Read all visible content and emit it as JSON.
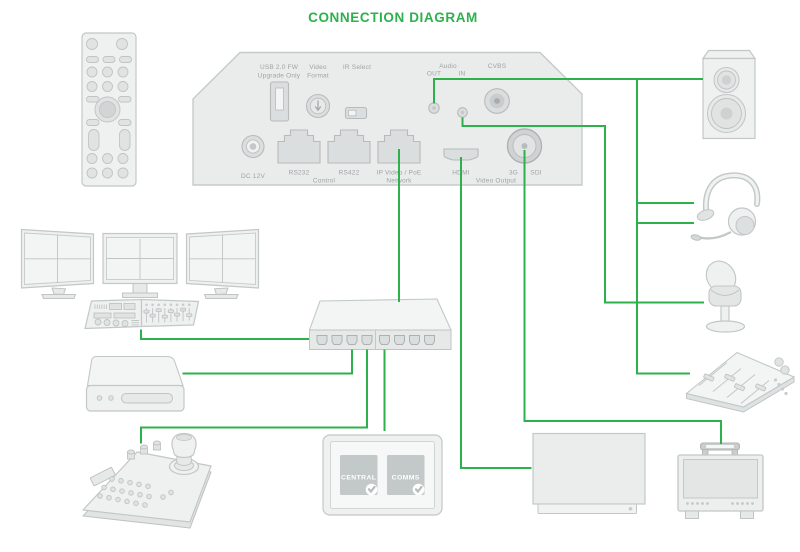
{
  "title": "CONNECTION DIAGRAM",
  "theme": {
    "accent": "#2CB14D",
    "device_stroke": "#C3C7C7",
    "device_fill": "#EFF0F0",
    "label_color": "#9EA4A4"
  },
  "rear_panel": {
    "labels": {
      "usb_line1": "USB 2.0 FW",
      "usb_line2": "Upgrade Only",
      "video_format_line1": "Video",
      "video_format_line2": "Format",
      "ir_select": "IR Select",
      "dc_12v": "DC 12V",
      "rs232": "RS232",
      "rs422": "RS422",
      "control": "Control",
      "ip_line1": "IP Video / PoE",
      "ip_line2": "Network",
      "audio": "Audio",
      "audio_out": "OUT",
      "audio_in": "IN",
      "cvbs": "CVBS",
      "hdmi": "HDMI",
      "sdi_3g": "3G",
      "sdi": "SDI",
      "video_output": "Video Output"
    }
  },
  "touch_panel": {
    "tile_1": "CENTRAL",
    "tile_2": "COMMS"
  },
  "devices": [
    {
      "id": "remote-control"
    },
    {
      "id": "monitor-wall"
    },
    {
      "id": "control-surface"
    },
    {
      "id": "rear-panel"
    },
    {
      "id": "network-switch"
    },
    {
      "id": "converter-box"
    },
    {
      "id": "joystick-controller"
    },
    {
      "id": "touch-panel"
    },
    {
      "id": "tv-display"
    },
    {
      "id": "field-monitor"
    },
    {
      "id": "speaker"
    },
    {
      "id": "headset"
    },
    {
      "id": "microphone"
    },
    {
      "id": "audio-mixer"
    }
  ],
  "connections": [
    {
      "from": "control-surface",
      "to": "network-switch"
    },
    {
      "from": "ip-video-poe-port",
      "to": "network-switch"
    },
    {
      "from": "network-switch",
      "to": "converter-box"
    },
    {
      "from": "network-switch",
      "to": "joystick-controller"
    },
    {
      "from": "network-switch",
      "to": "touch-panel"
    },
    {
      "from": "hdmi-port",
      "to": "tv-display"
    },
    {
      "from": "sdi-port",
      "to": "field-monitor"
    },
    {
      "from": "audio-out-jack",
      "to": "speaker"
    },
    {
      "from": "audio-out-jack",
      "to": "headset"
    },
    {
      "from": "audio-out-jack",
      "to": "headset-mic"
    },
    {
      "from": "audio-out-jack",
      "to": "audio-mixer"
    },
    {
      "from": "audio-in-jack",
      "to": "microphone"
    }
  ]
}
